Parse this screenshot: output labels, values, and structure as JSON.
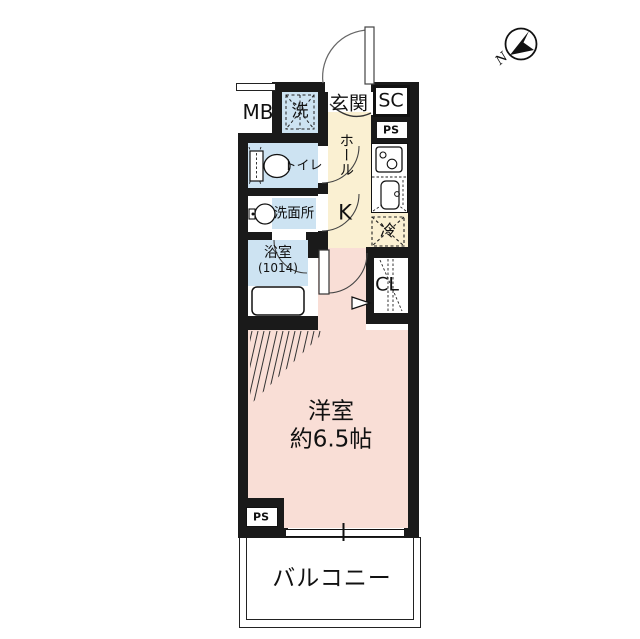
{
  "title": "apartment-floor-plan",
  "compass": {
    "north": "N"
  },
  "rooms": {
    "meter_box": "MB",
    "washer": "洗",
    "entrance": "玄関",
    "shoe_closet": "SC",
    "pipe_space_top": "PS",
    "hall": "ホール",
    "kitchen": "K",
    "toilet": "トイレ",
    "washroom": "洗面所",
    "bathroom": "浴室",
    "bathroom_size": "(1014)",
    "refrigerator": "冷",
    "closet": "CL",
    "main_room": "洋室",
    "main_room_size": "約6.5帖",
    "pipe_space_bottom": "PS",
    "balcony": "バルコニー"
  },
  "colors": {
    "wall": "#1a1a1a",
    "wet_area": "#cde3f2",
    "hall_kitchen": "#faf0d2",
    "western_room": "#f9ded6",
    "background": "#ffffff"
  }
}
